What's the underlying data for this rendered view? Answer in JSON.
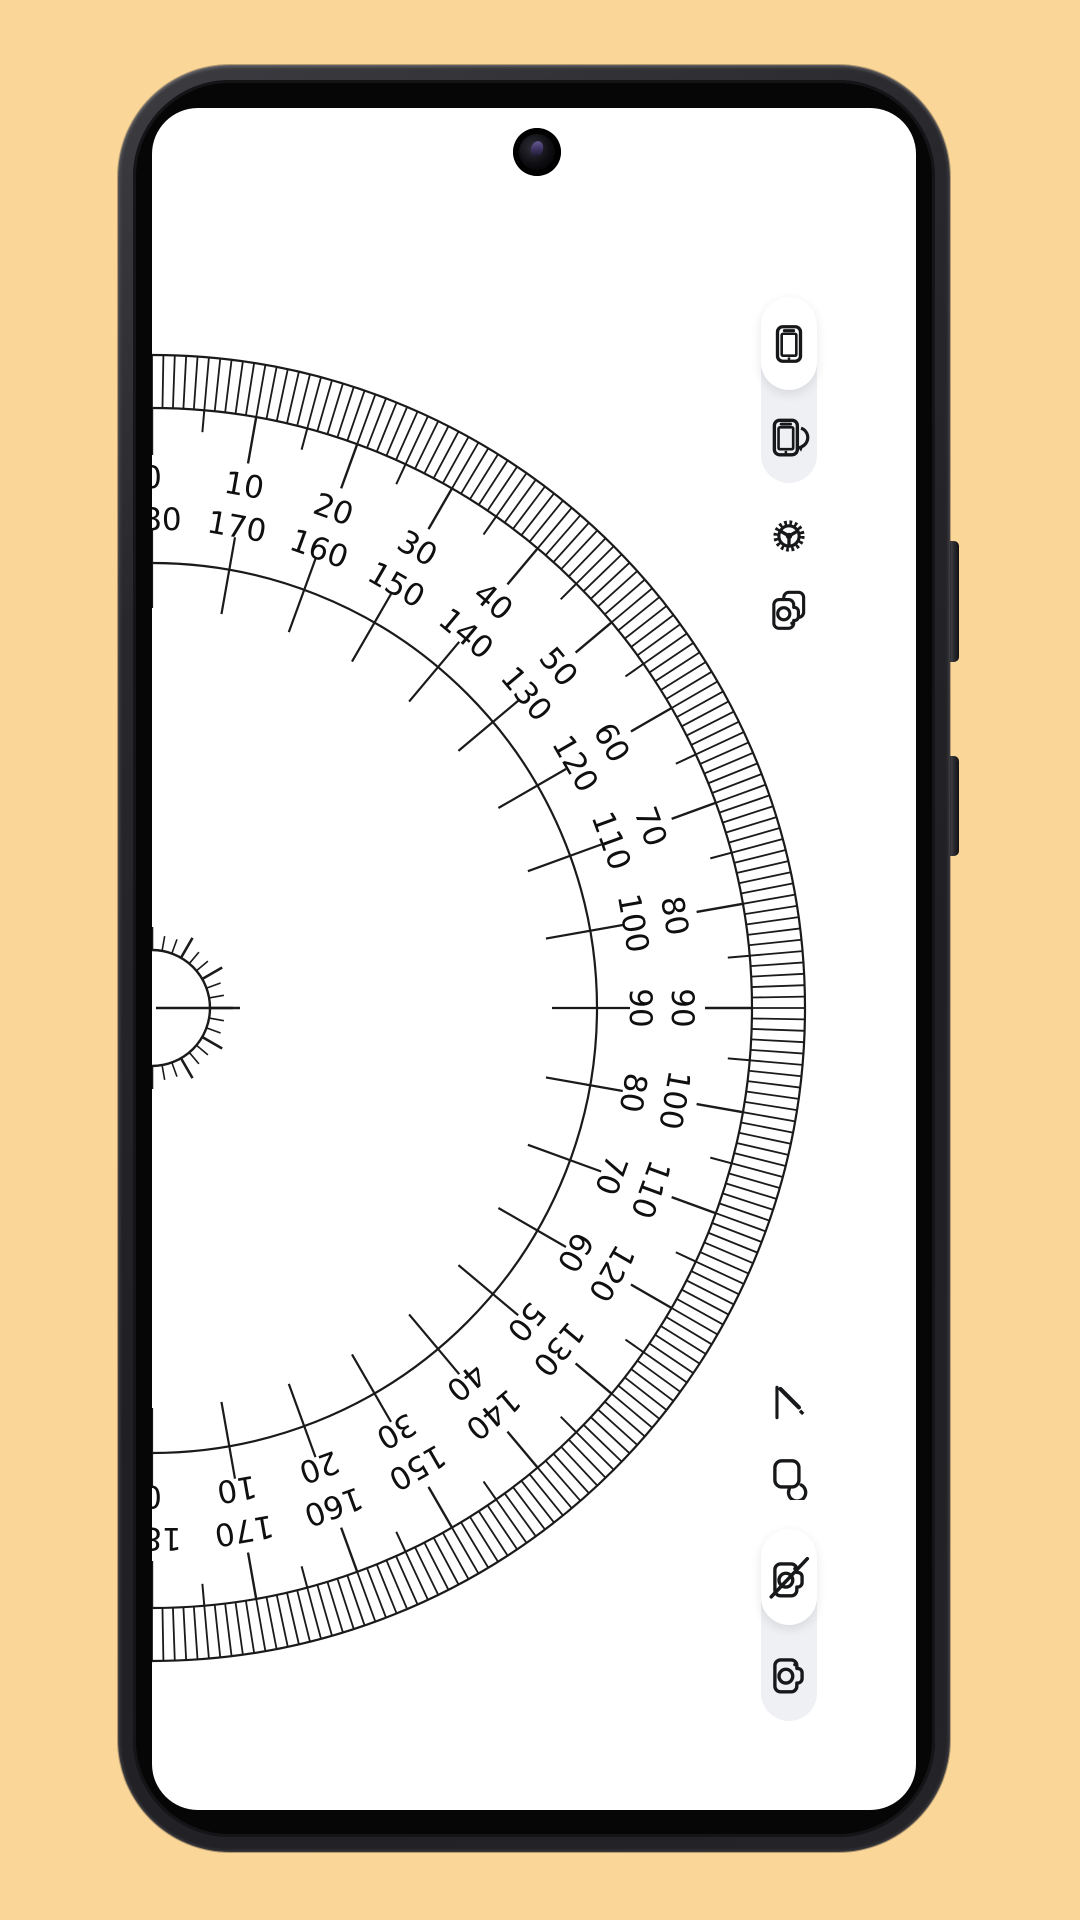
{
  "app": {
    "name": "Protractor"
  },
  "colors": {
    "canvas_bg": "#fad699",
    "screen_bg": "#ffffff",
    "ink": "#1a1a1a",
    "frame": "#2a2a2e",
    "pill_bg": "#eef0f3",
    "pill_active_bg": "#ffffff"
  },
  "protractor": {
    "min_deg": 0,
    "max_deg": 180,
    "label_step_deg": 10,
    "minor_tick_deg": 1,
    "outer_labels": [
      "0",
      "10",
      "20",
      "30",
      "40",
      "50",
      "60",
      "70",
      "80",
      "90",
      "100",
      "110",
      "120",
      "130",
      "140",
      "150",
      "160",
      "170",
      "180"
    ],
    "inner_labels": [
      "180",
      "170",
      "160",
      "150",
      "140",
      "130",
      "120",
      "110",
      "100",
      "90",
      "80",
      "70",
      "60",
      "50",
      "40",
      "30",
      "20",
      "10",
      "0"
    ]
  },
  "toolbar_top": {
    "items": [
      {
        "icon": "phone-portrait-icon",
        "active": true
      },
      {
        "icon": "phone-rotate-icon",
        "active": false
      },
      {
        "icon": "settings-gear-icon",
        "active": false
      },
      {
        "icon": "burst-copy-icon",
        "active": false
      }
    ]
  },
  "toolbar_bottom": {
    "items": [
      {
        "icon": "draw-pen-icon",
        "active": false
      },
      {
        "icon": "shapes-icon",
        "active": false
      },
      {
        "icon": "camera-off-icon",
        "active": true
      },
      {
        "icon": "camera-icon",
        "active": false
      }
    ]
  }
}
